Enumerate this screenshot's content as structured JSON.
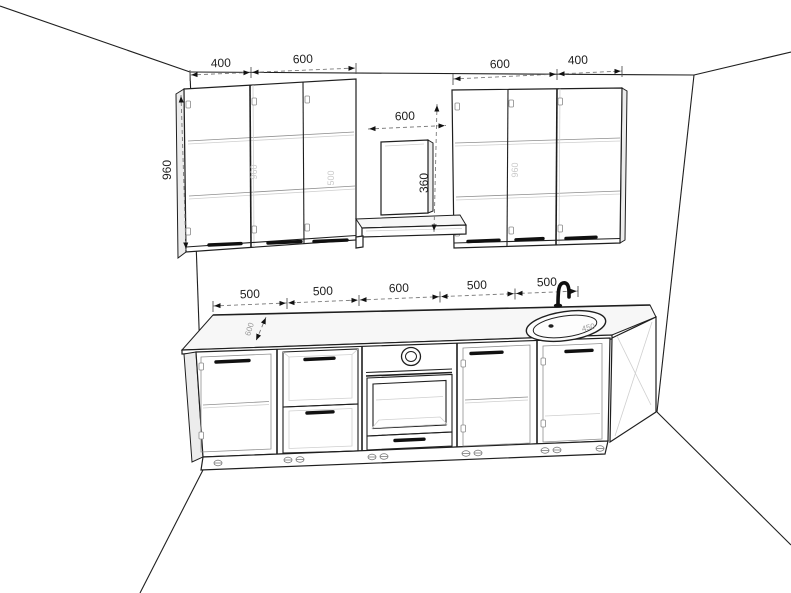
{
  "scene": {
    "description": "3D kitchen layout drawing with dimension annotations",
    "background": "#ffffff",
    "line_color": "#1f1f1f"
  },
  "dims": {
    "upper_left": [
      "400",
      "600"
    ],
    "upper_right": [
      "600",
      "400"
    ],
    "hood_width": "600",
    "hood_height": "360",
    "upper_height": "960",
    "base": [
      "500",
      "500",
      "600",
      "500",
      "500"
    ],
    "counter_depth": "600",
    "sink_diameter": "450",
    "interior": [
      "960",
      "500",
      "960"
    ]
  }
}
